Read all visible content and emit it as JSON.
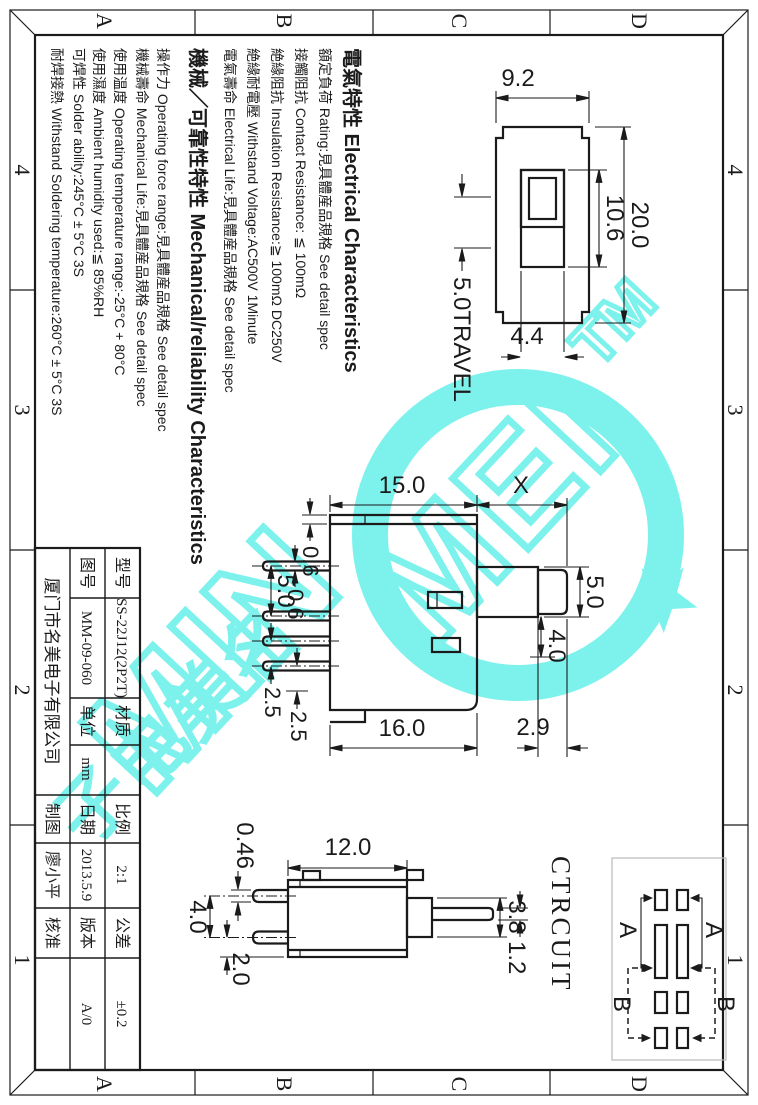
{
  "colors": {
    "line": "#1b1b1b",
    "watermark_cyan": "#7df2ec",
    "circuit_box_gray": "#b9b9b9",
    "paper": "#ffffff"
  },
  "frame": {
    "zone_numbers": [
      "4",
      "3",
      "2",
      "1"
    ],
    "zone_letters": [
      "D",
      "C",
      "B",
      "A"
    ]
  },
  "notes": {
    "lines": [
      {
        "text": "電氣特性 Electrical Characteristics"
      },
      {
        "text": "額定負荷 Rating:見具體産品規格 See detail spec"
      },
      {
        "text": "接觸阻抗 Contact Resistance: ≦ 100mΩ"
      },
      {
        "text": "絶緣阻抗 Insulation Resistance:≧ 100mΩ DC250V"
      },
      {
        "text": "絶緣耐電壓 Withstand Voltage:AC500V 1Minute"
      },
      {
        "text": "電氣壽命 Electrical Life:見具體産品規格 See detail spec"
      },
      {
        "text": "機械／可靠性特性 Mechanical/reliability Characteristics"
      },
      {
        "text": "操作力 Operating force range:見具體産品規格 See detail spec"
      },
      {
        "text": "機械壽命 Mechanical Life:見具體産品規格 See detail spec"
      },
      {
        "text": "使用温度 Operating temperature range:-25°C + 80°C"
      },
      {
        "text": "使用濕度 Ambient humidity used:≦ 85%RH"
      },
      {
        "text": "可焊性 Solder ability:245°C ± 5°C  3S"
      },
      {
        "text": "耐焊接熱 Withstand Soldering temperature:260°C ± 5°C  3S"
      }
    ]
  },
  "dims": {
    "tv_width": "20.0",
    "tv_slot": "10.6",
    "tv_height": "9.2",
    "tv_knob": "4.4",
    "tv_travel": "5.0TRAVEL",
    "fv_body": "15.0",
    "fv_x": "X",
    "fv_knob_w": "5.0",
    "fv_cap_w": "4.0",
    "fv_cap_h": "2.9",
    "fv_total": "16.0",
    "fv_cover": "0.6",
    "fv_pin": "0.6",
    "fv_pitch_a": "5.0",
    "fv_pitch_b": "2.5",
    "fv_pitch_c": "2.5",
    "sv_body": "12.0",
    "sv_pin": "0.46",
    "sv_pitch": "4.0",
    "sv_edge": "2.0",
    "sv_base": "3.8",
    "sv_shaft": "1.2"
  },
  "circuit": {
    "label": "CTRCUIT",
    "state_a": "A",
    "state_b": "B"
  },
  "title_block": {
    "model_label": "型号",
    "model_value": "SS-22J12(2P2T)",
    "material_label": "材质",
    "material_value": "",
    "scale_label": "比例",
    "scale_value": "2:1",
    "tolerance_label": "公差",
    "tolerance_value": "±0.2",
    "drawing_no_label": "图号",
    "drawing_no_value": "MM-09-060",
    "unit_label": "单位",
    "unit_value": "mm",
    "date_label": "日期",
    "date_value": "2013.5.9",
    "version_label": "版本",
    "version_value": "A/0",
    "company": "厦门市名美电子有限公司",
    "drawn_label": "制图",
    "drawn_value": "廖小平",
    "approved_label": "核准",
    "approved_value": ""
  },
  "watermark": {
    "brand_first": "MIN",
    "brand_second": "MEI",
    "tm": "TM",
    "cjk_chars": [
      "名",
      "美",
      "电",
      "子"
    ]
  }
}
